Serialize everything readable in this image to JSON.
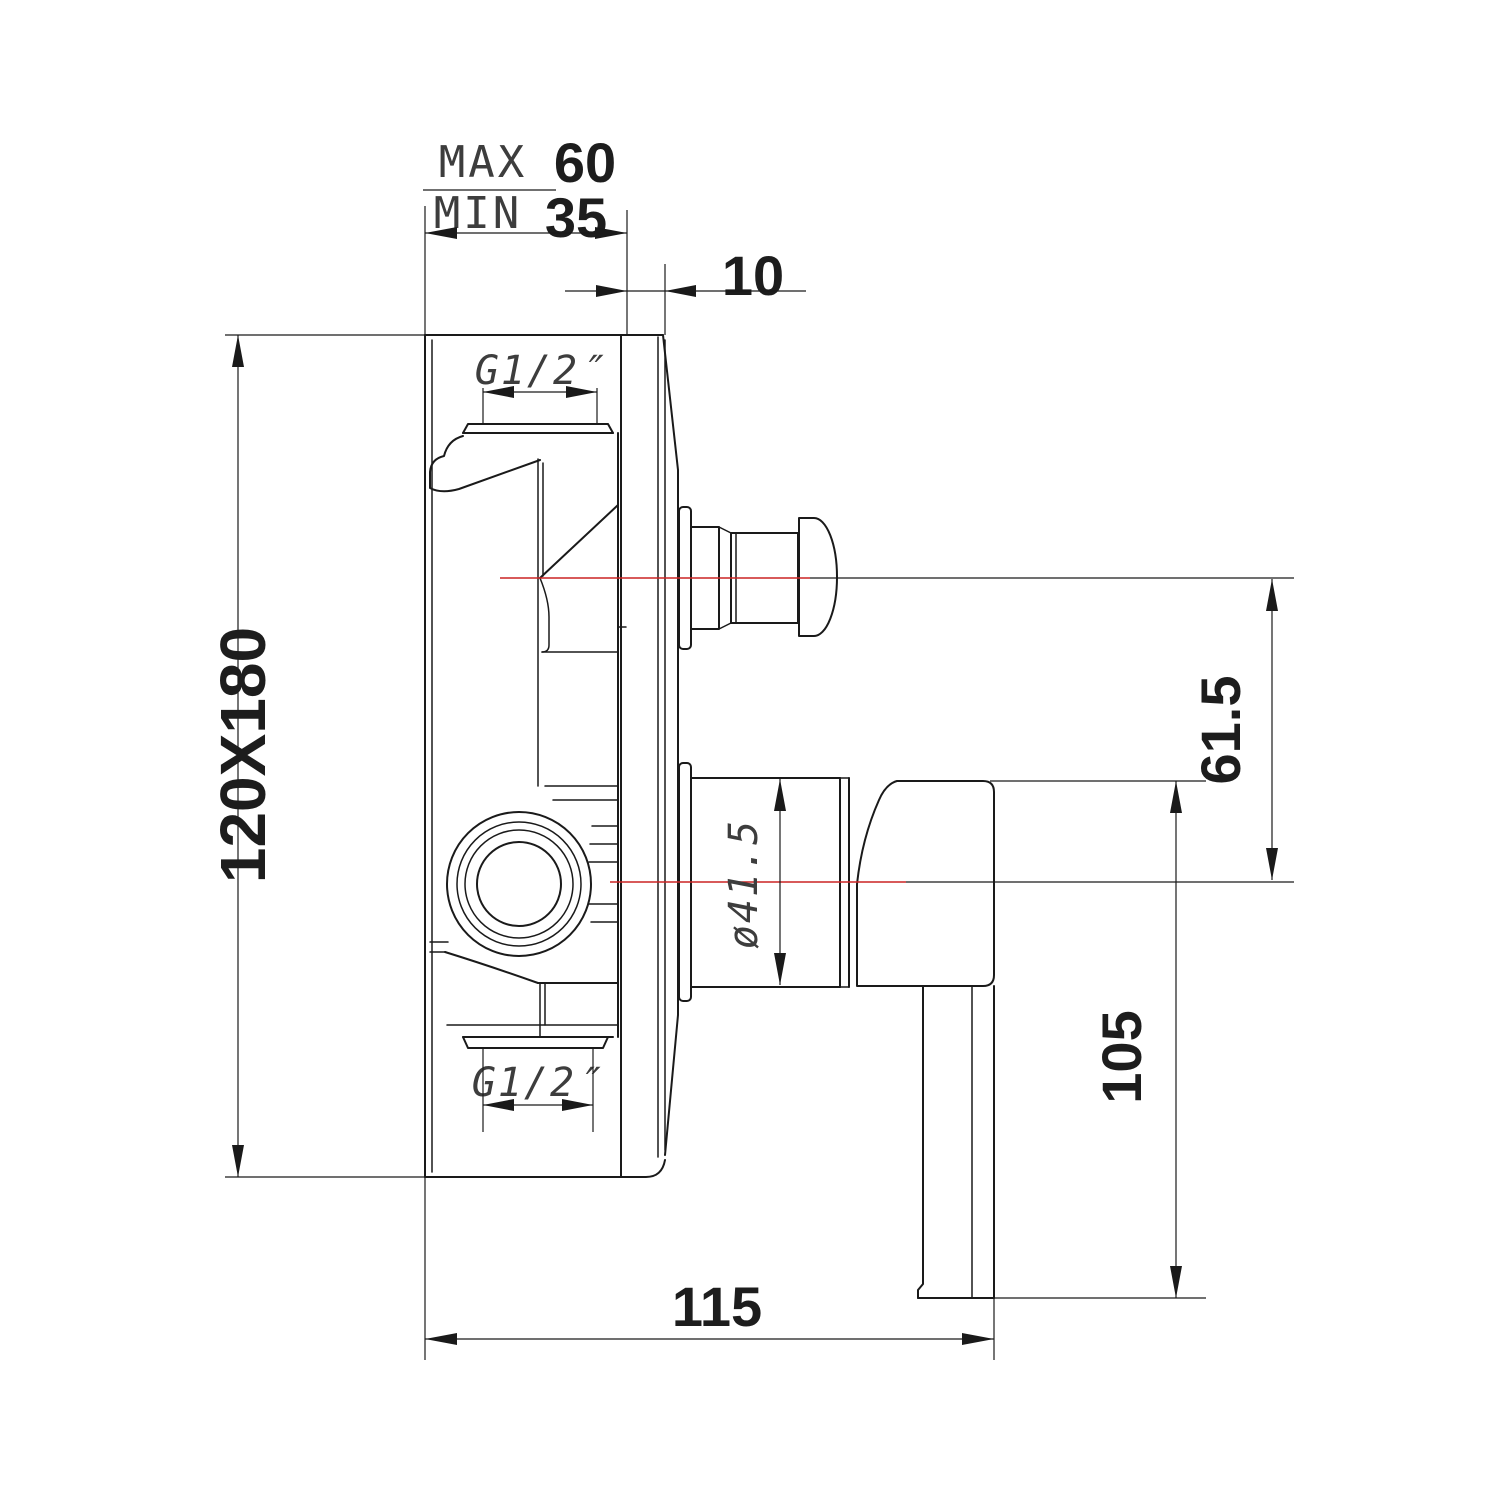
{
  "drawing": {
    "type": "technical-dimension-drawing",
    "subject": "concealed shower mixer valve - side view",
    "colors": {
      "line": "#1a1a1a",
      "centerline": "#cc2424",
      "background": "#ffffff"
    },
    "dims": {
      "wall_depth_max_label": "MAX",
      "wall_depth_max": "60",
      "wall_depth_min_label": "MIN",
      "wall_depth_min": "35",
      "plate_offset": "10",
      "plate_size": "120X180",
      "top_port_thread": "G1/2″",
      "bottom_port_thread": "G1/2″",
      "diverter_center_height": "61.5",
      "sleeve_diameter": "ø41.5",
      "lever_length": "105",
      "total_depth": "115"
    }
  }
}
